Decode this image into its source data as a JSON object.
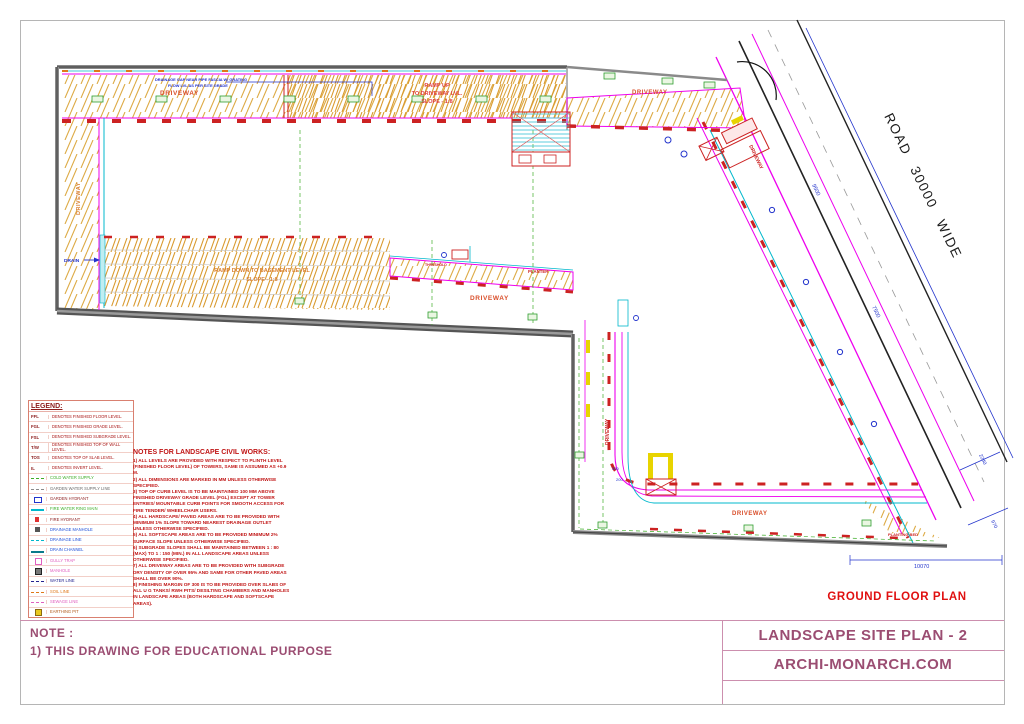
{
  "colors": {
    "accent_maroon": "#9b4d72",
    "note_red": "#c01616",
    "cad_orange": "#d9820f",
    "cad_magenta": "#ee00ee",
    "cad_cyan": "#00b8cc",
    "cad_green": "#3fae29",
    "cad_blue": "#2233cc",
    "road_black": "#222222",
    "plan_caption_red": "#e01010"
  },
  "drawing": {
    "road_label": "ROAD 30000 WIDE",
    "plan_caption": "GROUND FLOOR PLAN",
    "labels": {
      "driveway": "DRIVEWAY",
      "ramp_up_1": "RAMP UP",
      "ramp_up_2": "TO DRIVEWAY LVL.",
      "ramp_up_3": "SLOPE - 1:8",
      "ramp_down_1": "RAMP DOWN TO BASEMENT LEVEL",
      "ramp_down_2": "SLOPE - 1:8",
      "drain": "DRAIN",
      "planter": "PLANTER",
      "threshold": "THRESHOLD",
      "planting_bed": "PLANTING BED",
      "drainage_note_1": "DRAINAGE GAP NEAR PIPE FASCIA W/ GRATING",
      "drainage_note_2": "FLOW LVL AS PER SITE GRADE"
    },
    "dims": {
      "d_9500": "9500",
      "d_7500": "7500",
      "d_2240": "2240",
      "d_970": "970",
      "d_10070": "10070",
      "d_300": "300",
      "d_200": "200"
    }
  },
  "legend": {
    "title": "LEGEND:",
    "abbrev": [
      {
        "key": "FFL",
        "desc": "DENOTES FINISHED FLOOR LEVEL."
      },
      {
        "key": "FGL",
        "desc": "DENOTES FINISHED GRADE LEVEL."
      },
      {
        "key": "FSL",
        "desc": "DENOTES FINISHED SUBGRADE LEVEL."
      },
      {
        "key": "T/W",
        "desc": "DENOTES FINISHED TOP OF WALL LEVEL."
      },
      {
        "key": "TOS",
        "desc": "DENOTES TOP OF SLAB LEVEL."
      },
      {
        "key": "IL",
        "desc": "DENOTES INVERT LEVEL."
      }
    ],
    "symbols": [
      {
        "symbol": "dash-green",
        "label": "COLD WATER SUPPLY",
        "color": "#3fae29"
      },
      {
        "symbol": "dashdot-gray",
        "label": "GARDEN WATER SUPPLY LINE",
        "color": "#6b6b6b"
      },
      {
        "symbol": "hydrant-blue",
        "label": "GARDEN HYDRANT",
        "color": "#8b1a1a"
      },
      {
        "symbol": "line-cyan",
        "label": "FIRE WATER RING MAIN",
        "color": "#3fae29"
      },
      {
        "symbol": "flag-red",
        "label": "FIRE HYDRANT",
        "color": "#8b1a1a"
      },
      {
        "symbol": "square-dark",
        "label": "DRAINAGE MANHOLE",
        "color": "#1f4fd8"
      },
      {
        "symbol": "dash-cyan",
        "label": "DRAINAGE LINE",
        "color": "#1f4fd8"
      },
      {
        "symbol": "line-thick-teal",
        "label": "DRAIN CHANNEL",
        "color": "#1f4fd8"
      },
      {
        "symbol": "square-pink",
        "label": "GULLY TRAP",
        "color": "#e060c0"
      },
      {
        "symbol": "square-mh",
        "label": "MANHOLE",
        "color": "#e060c0"
      },
      {
        "symbol": "dashdot-blue",
        "label": "WATER LINE",
        "color": "#23238f"
      },
      {
        "symbol": "dash-orange",
        "label": "SOIL LINE",
        "color": "#e07818"
      },
      {
        "symbol": "dash-pink",
        "label": "SEWAGE LINE",
        "color": "#e060c0"
      },
      {
        "symbol": "square-yellow",
        "label": "EARTHING PIT",
        "color": "#b05818"
      }
    ]
  },
  "notes": {
    "title": "NOTES FOR LANDSCAPE CIVIL WORKS:",
    "items": [
      "1) ALL LEVELS ARE PROVIDED WITH RESPECT TO PLINTH LEVEL (FINISHED FLOOR LEVEL) OF TOWERS, SAME IS ASSUMED AS +0.9 M.",
      "2) ALL DIMENSIONS ARE MARKED IN MM UNLESS OTHERWISE SPECIFIED.",
      "3) TOP OF CURB LEVEL IS TO BE MAINTAINED 100 MM ABOVE FINISHED DRIVEWAY GRADE LEVEL (FGL) EXCEPT AT TOWER ENTRIES/ MOUNTABLE CURB POINTS FOR SMOOTH ACCESS FOR FIRE TENDER/ WHEELCHAIR USERS.",
      "4) ALL HARDSCAPE/ PAVED AREAS ARE TO BE PROVIDED WITH MINIMUM 1% SLOPE TOWARD NEAREST DRAINAGE OUTLET UNLESS OTHERWISE SPECIFIED.",
      "5) ALL SOFTSCAPE AREAS ARE TO BE PROVIDED MINIMUM 2% SURFACE SLOPE UNLESS OTHERWISE SPECIFIED.",
      "6) SUBGRADE SLOPES SHALL BE MAINTAINED BETWEEN 1 : 80 (MAX) TO 1 : 150 (MIN.) IN ALL LANDSCAPE AREAS UNLESS OTHERWISE SPECIFIED.",
      "7) ALL DRIVEWAY AREAS ARE TO BE PROVIDED WITH SUBGRADE DRY DENSITY OF OVER 95% AND SAME FOR OTHER PAVED AREAS SHALL BE OVER 90%.",
      "8) FINISHING MARGIN OF 300 IS TO BE PROVIDED OVER SLABS OF ALL U G TANKS/ RWH PITS/ DESILTING CHAMBERS AND MANHOLES IN LANDSCAPE AREAS (BOTH HARDSCAPE AND SOFTSCAPE AREAS)."
    ]
  },
  "footer": {
    "note_title": "NOTE :",
    "note_text": "1) THIS DRAWING FOR EDUCATIONAL PURPOSE",
    "sheet_title": "LANDSCAPE SITE PLAN - 2",
    "brand": "ARCHI-MONARCH.COM"
  }
}
